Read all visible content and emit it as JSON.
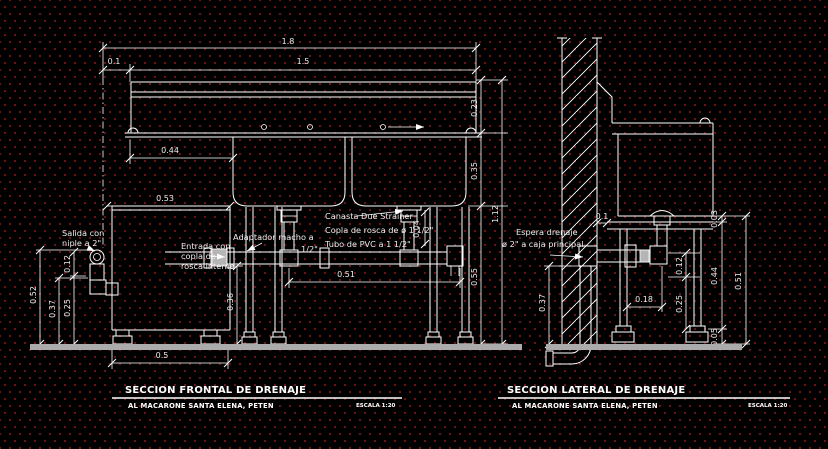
{
  "front_section": {
    "title": "SECCION FRONTAL DE DRENAJE",
    "location": "AL MACARONE SANTA ELENA, PETEN",
    "scale": "ESCALA 1:20",
    "labels": {
      "salida_line1": "Salida con",
      "salida_line2": "niple a 2\"",
      "entrada_line1": "Entrada con",
      "entrada_line2": "copla de",
      "entrada_line3": "rosca interna",
      "adaptador_line1": "Adaptador macho a",
      "adaptador_line2": "1/2\"",
      "canasta": "Canasta Due Strainer",
      "copla": "Copla de rosca de ø 1 1/2\"",
      "tubo": "Tubo de PVC a 1 1/2\""
    },
    "dims": {
      "d_1_8": "1.8",
      "d_0_1": "0.1",
      "d_1_5": "1.5",
      "d_0_23": "0.23",
      "d_0_44": "0.44",
      "d_0_53": "0.53",
      "d_0_35": "0.35",
      "d_1_12": "1.12",
      "d_0_55": "0.55",
      "d_0_52": "0.52",
      "d_0_37": "0.37",
      "d_0_25": "0.25",
      "d_0_12": "0.12",
      "d_0_51": "0.51",
      "d_0_36": "0.36",
      "d_0_5": "0.5",
      "d_0_04": "0.04"
    }
  },
  "lateral_section": {
    "title": "SECCION LATERAL DE DRENAJE",
    "location": "AL MACARONE SANTA ELENA, PETEN",
    "scale": "ESCALA 1:20",
    "labels": {
      "espera_line1": "Espera drenaje",
      "espera_line2": "ø 2\" a caja principal"
    },
    "dims": {
      "d_0_1": "0.1",
      "d_0_03": "0.03",
      "d_0_12": "0.12",
      "d_0_44": "0.44",
      "d_0_51": "0.51",
      "d_0_18": "0.18",
      "d_0_25": "0.25",
      "d_0_05": "0.05",
      "d_0_37": "0.37"
    }
  }
}
